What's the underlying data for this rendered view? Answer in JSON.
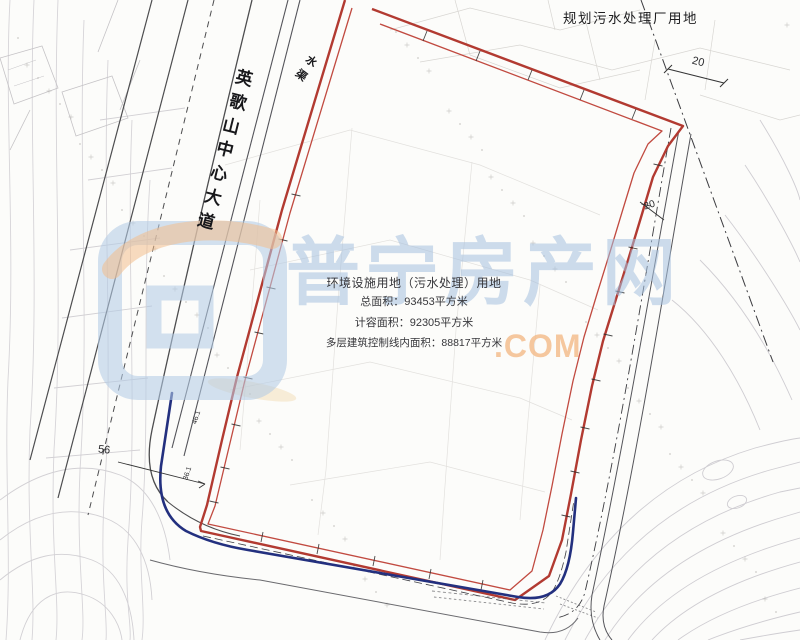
{
  "labels": {
    "planned_area": "规划污水处理厂用地",
    "road": "英歌山中心大道",
    "channel": "水渠"
  },
  "info_block": {
    "line1": "环境设施用地（污水处理）用地",
    "line2": "总面积：93453平方米",
    "line3": "计容面积：92305平方米",
    "line4": "多层建筑控制线内面积：88817平方米"
  },
  "dimensions": {
    "d1": "20",
    "d2": "20",
    "d3": "56",
    "d4": "36.1",
    "d5": "46.1"
  },
  "watermark": {
    "brand": "普宁房产网",
    "domain_suffix": ".COM"
  },
  "colors": {
    "boundary_red": "#b23a31",
    "boundary_red_inner": "#c14a40",
    "road_blue": "#23307f",
    "contour_gray": "#d6d4d8",
    "watermark_blue": "#a4c0df",
    "watermark_orange": "#f2b987"
  }
}
